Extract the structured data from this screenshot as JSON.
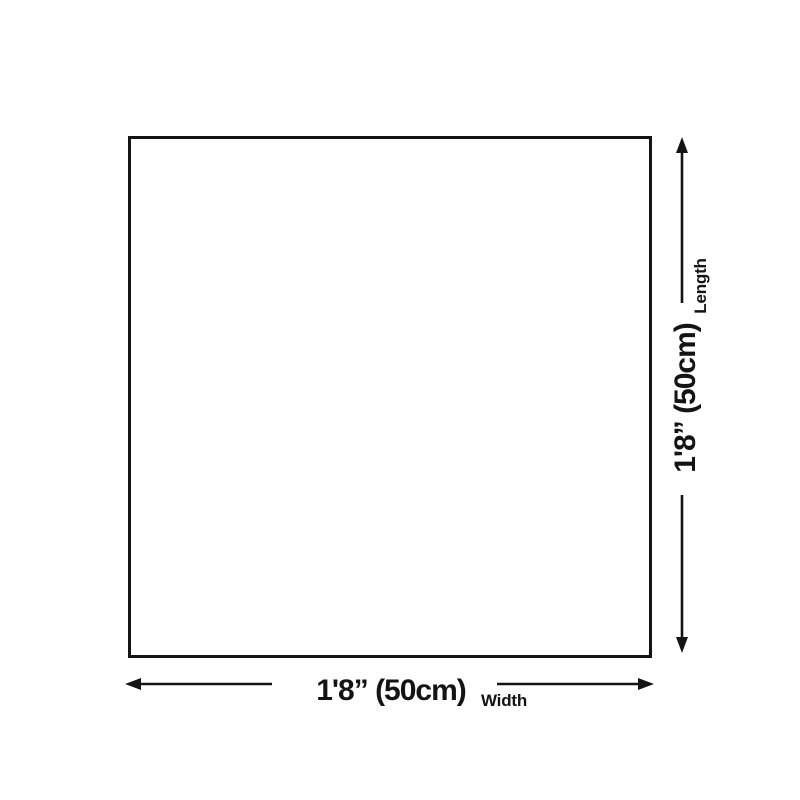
{
  "diagram": {
    "type": "product-dimension-diagram",
    "background_color": "#ffffff",
    "line_color": "#141414",
    "product": {
      "shape": "square",
      "fill": "#ffffff",
      "border_color": "#141414"
    },
    "width": {
      "value": "1'8” (50cm)",
      "label": "Width",
      "arrow_icons": [
        "arrow-left",
        "arrow-right"
      ]
    },
    "length": {
      "value": "1'8” (50cm)",
      "label": "Length",
      "arrow_icons": [
        "arrow-up",
        "arrow-down"
      ]
    }
  }
}
